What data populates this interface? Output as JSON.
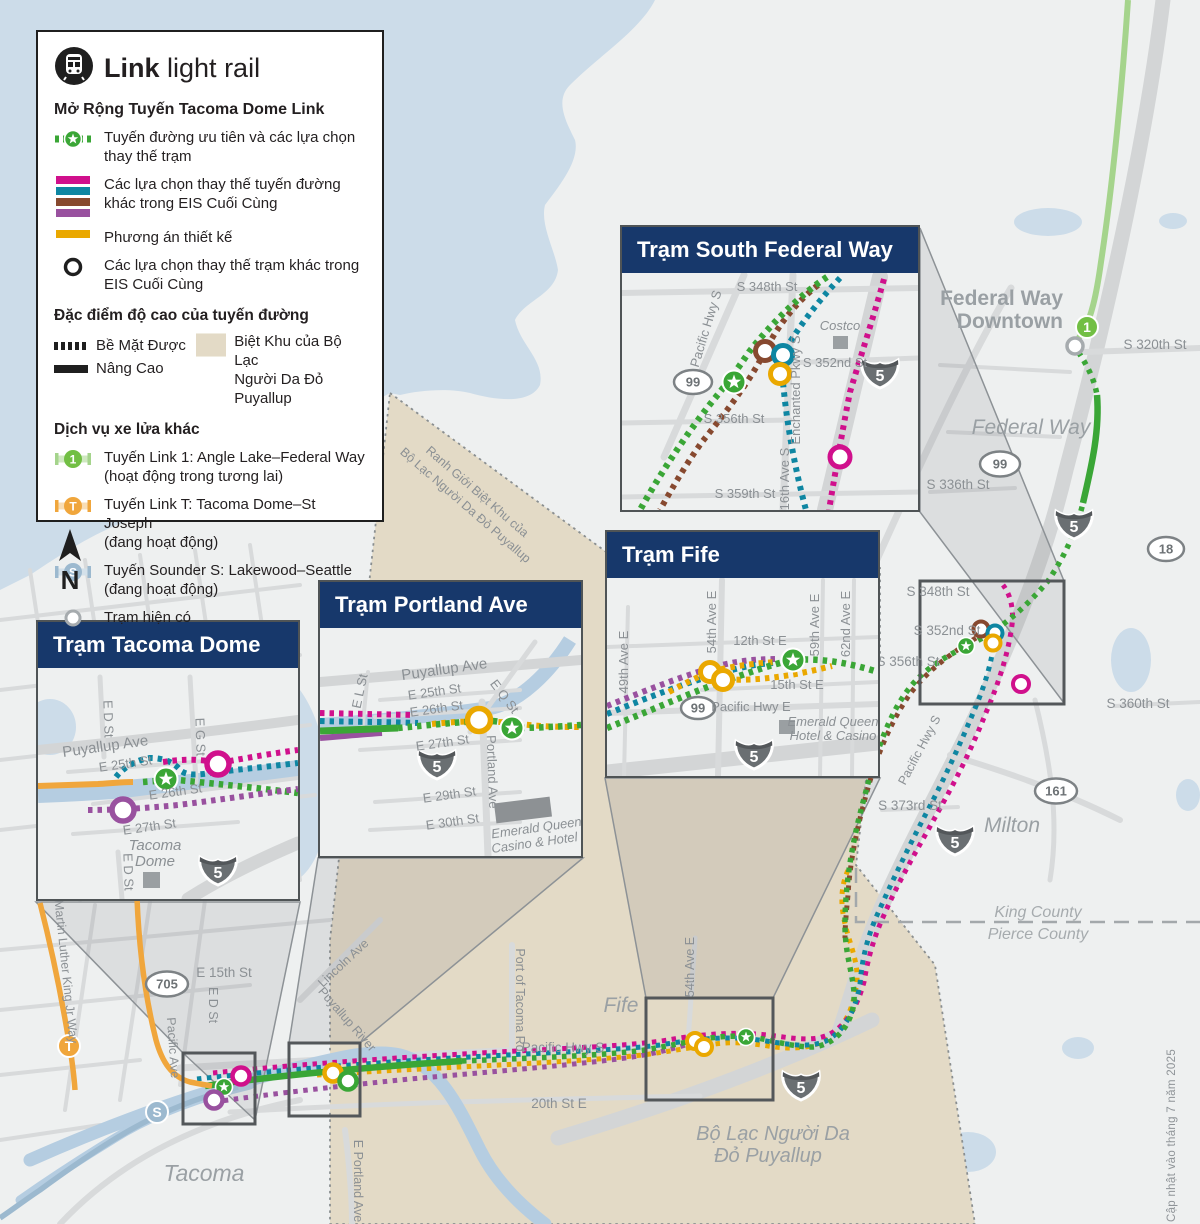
{
  "colors": {
    "navy": "#17386b",
    "green": "#3aa636",
    "light_green": "#a5d48c",
    "magenta": "#d0108c",
    "teal": "#0e86a2",
    "brown": "#87492f",
    "purple": "#99519f",
    "orange": "#eaa800",
    "tan": "#e3dac6",
    "water": "#ccdce9",
    "river": "#b5cde1",
    "land": "#eef0f0",
    "road": "#d8dadb",
    "badge_1": "#72bf44",
    "badge_t": "#f0a63c",
    "badge_s": "#9cb9cf"
  },
  "legend": {
    "title_bold": "Link",
    "title_rest": "light rail",
    "subtitle": "Mở Rộng Tuyến Tacoma Dome Link",
    "preferred_1": "Tuyến đường ưu tiên và các lựa chọn",
    "preferred_2": "thay thế trạm",
    "alternatives_1": "Các lựa chọn thay thế tuyến đường",
    "alternatives_2": "khác trong EIS Cuối Cùng",
    "design_label": "Phương án thiết kế",
    "station_alt_1": "Các lựa chọn thay thế trạm khác trong",
    "station_alt_2": "EIS Cuối Cùng",
    "elevation_heading": "Đặc điểm độ cao của tuyến đường",
    "surface_label": "Bề Mặt Được",
    "elevated_label": "Nâng Cao",
    "reservation_1": "Biệt Khu của Bộ Lạc",
    "reservation_2": "Người Da Đỏ Puyallup",
    "services_heading": "Dịch vụ xe lửa khác",
    "service1_1": "Tuyến Link 1: Angle Lake–Federal Way",
    "service1_2": "(hoạt động trong tương lai)",
    "service2_1": "Tuyến Link T: Tacoma Dome–St Joseph",
    "service2_2": "(đang hoạt động)",
    "service3_1": "Tuyến Sounder S: Lakewood–Seattle",
    "service3_2": "(đang hoạt động)",
    "existing_station": "Trạm hiện có"
  },
  "compass": "N",
  "badges": {
    "link1": "1",
    "link_t": "T",
    "sounder": "S"
  },
  "shields": {
    "i5": "5",
    "us99": "99",
    "wa18": "18",
    "wa161": "161",
    "wa705": "705"
  },
  "insets": {
    "sfw": {
      "title": "Trạm South Federal Way",
      "s348": "S 348th St",
      "pacific_hwy": "Pacific Hwy S",
      "s352": "S 352nd St",
      "s356": "S 356th St",
      "s359": "S 359th St",
      "ave16": "16th Ave S",
      "enchanted": "Enchanted Pkwy S",
      "costco": "Costco"
    },
    "fife": {
      "title": "Trạm Fife",
      "ave49": "49th Ave E",
      "ave54": "54th Ave E",
      "st12": "12th St E",
      "ave59": "59th Ave E",
      "ave62": "62nd Ave E",
      "st15": "15th St E",
      "pacific": "Pacific Hwy E",
      "eq1": "Emerald Queen",
      "eq2": "Hotel & Casino"
    },
    "pdx": {
      "title": "Trạm Portland Ave",
      "puyallup": "Puyallup Ave",
      "e25": "E 25th St",
      "e26": "E 26th St",
      "el_st": "E L St",
      "eq_st": "E Q St",
      "e27": "E 27th St",
      "portland": "Portland Ave",
      "e29": "E 29th St",
      "e30": "E 30th St",
      "eq1": "Emerald Queen",
      "eq2": "Casino & Hotel"
    },
    "tac": {
      "title": "Trạm Tacoma Dome",
      "ed_st": "E D St",
      "puyallup": "Puyallup Ave",
      "e25": "E 25th St",
      "eg_st": "E G St",
      "e26": "E 26th St",
      "e27": "E 27th St",
      "dome1": "Tacoma",
      "dome2": "Dome",
      "ed_st2": "E D St"
    }
  },
  "map_labels": {
    "fwd1": "Federal Way",
    "fwd2": "Downtown",
    "s320": "S 320th St",
    "federal_way": "Federal Way",
    "s336": "S 336th St",
    "s348": "S 348th St",
    "s352": "S 352nd St",
    "s356": "S 356th St",
    "s360": "S 360th St",
    "s373": "S 373rd St",
    "pacific_hwy_s": "Pacific Hwy S",
    "milton": "Milton",
    "king_county": "King County",
    "pierce_county": "Pierce County",
    "fife": "Fife",
    "ave54": "54th Ave E",
    "port_of_tacoma": "Port of Tacoma Rd",
    "pacific_hwy_s2": "Pacific Hwy S",
    "st20": "20th St E",
    "tribal1": "Bộ Lạc Người Da",
    "tribal2": "Đỏ Puyallup",
    "boundary1": "Ranh Giới Biệt Khu của",
    "boundary2": "Bộ Lạc Người Da Đỏ Puyallup",
    "mlk": "Martin Luther King Jr Way",
    "e15": "E 15th St",
    "ed_st": "E D St",
    "pacific_ave": "Pacific Ave",
    "tacoma": "Tacoma",
    "lincoln": "Lincoln Ave",
    "puyallup_river": "Puyallup River",
    "e_portland": "E Portland Ave"
  },
  "credit": "Cập nhật vào tháng 7 năm 2025"
}
